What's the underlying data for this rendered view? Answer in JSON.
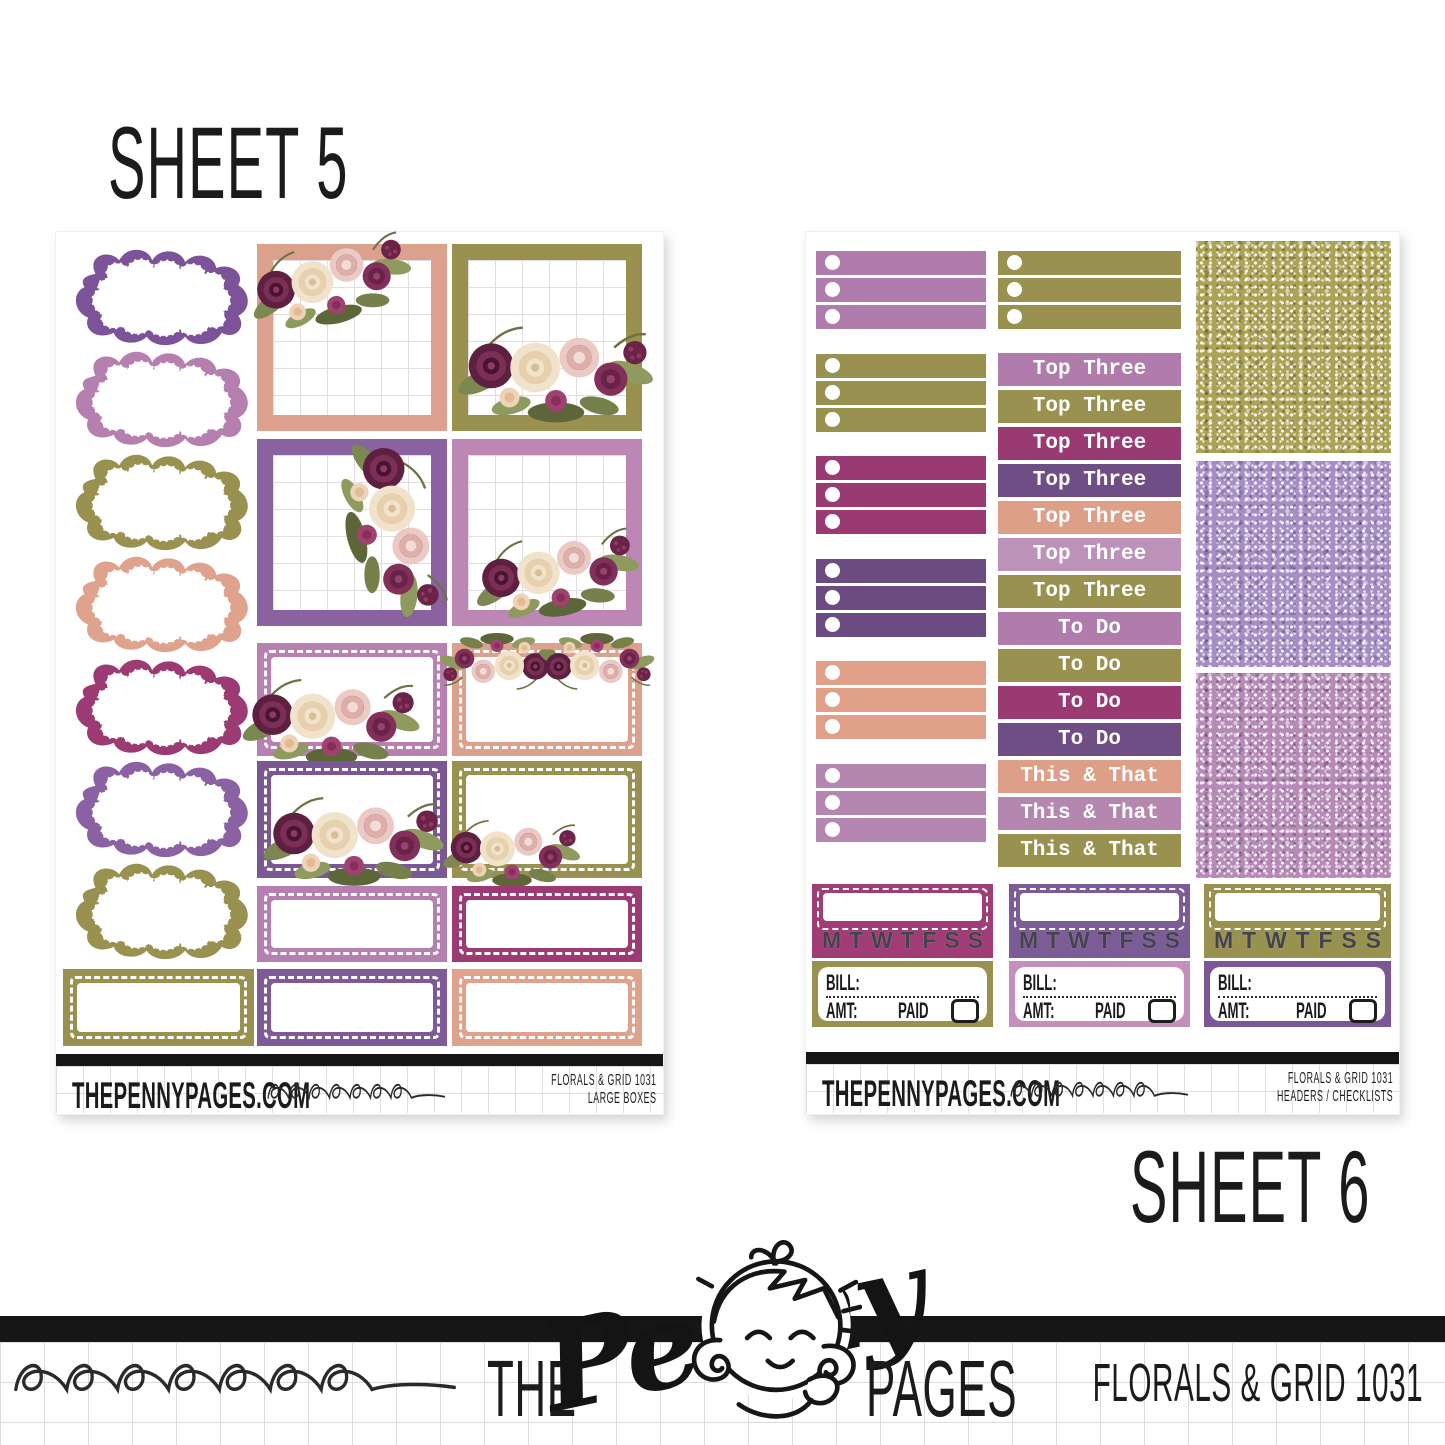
{
  "page": {
    "sheet5_label": "SHEET 5",
    "sheet6_label": "SHEET 6",
    "brand": {
      "the": "THE",
      "penny": "Penny",
      "pages": "PAGES"
    },
    "product_name": "FLORALS & GRID 1031",
    "accent_black": "#161616"
  },
  "days": [
    "M",
    "T",
    "W",
    "T",
    "F",
    "S",
    "S"
  ],
  "sheet5": {
    "footer": {
      "site": "THEPENNYPAGES.COM",
      "product_line1": "FLORALS & GRID 1031",
      "product_line2": "LARGE BOXES"
    },
    "clouds": [
      {
        "color": "#7c5398"
      },
      {
        "color": "#b57fb0"
      },
      {
        "color": "#99914f"
      },
      {
        "color": "#dfa38d"
      },
      {
        "color": "#9c3b73"
      },
      {
        "color": "#8a61a2"
      },
      {
        "color": "#99914f"
      }
    ],
    "bottom_label_box": {
      "color": "#99914f"
    },
    "full_boxes": [
      {
        "frame": "#dba18c",
        "flowers": "top-left"
      },
      {
        "frame": "#99914f",
        "flowers": "bottom"
      },
      {
        "frame": "#8a62a0",
        "flowers": "right"
      },
      {
        "frame": "#bc87b4",
        "flowers": "bottom-right"
      }
    ],
    "half_boxes": [
      {
        "bg": "#b780b1",
        "flowers": "bottom-left"
      },
      {
        "bg": "#dba18c",
        "flowers": "top-corners"
      },
      {
        "bg": "#7b5794",
        "flowers": "bottom"
      },
      {
        "bg": "#99914f",
        "flowers": "bottom-left"
      }
    ],
    "quarter_boxes": [
      {
        "bg": "#b57fb0"
      },
      {
        "bg": "#9c3b73"
      },
      {
        "bg": "#7f5a98"
      },
      {
        "bg": "#dfa38d"
      }
    ]
  },
  "sheet6": {
    "checklist_groups": [
      {
        "color": "#b07cab"
      },
      {
        "color": "#99914f"
      },
      {
        "color": "#9a3a72"
      },
      {
        "color": "#6b4b80"
      },
      {
        "color": "#df9f88"
      },
      {
        "color": "#b586b0"
      }
    ],
    "mid_strip_color": "#99914f",
    "headers": [
      {
        "label": "Top Three",
        "color": "#b07cab"
      },
      {
        "label": "Top Three",
        "color": "#99914f"
      },
      {
        "label": "Top Three",
        "color": "#9a3a72"
      },
      {
        "label": "Top Three",
        "color": "#6f4e85"
      },
      {
        "label": "Top Three",
        "color": "#dd9f88"
      },
      {
        "label": "Top Three",
        "color": "#bd92b8"
      },
      {
        "label": "Top Three",
        "color": "#99914f"
      },
      {
        "label": "To Do",
        "color": "#b07cab"
      },
      {
        "label": "To Do",
        "color": "#99914f"
      },
      {
        "label": "To Do",
        "color": "#9a3a72"
      },
      {
        "label": "To Do",
        "color": "#6f4e85"
      },
      {
        "label": "This & That",
        "color": "#dd9f88"
      },
      {
        "label": "This & That",
        "color": "#b586b0"
      },
      {
        "label": "This & That",
        "color": "#99914f"
      }
    ],
    "glitter_swatches": [
      {
        "name": "olive-glitter",
        "base": "#aca254"
      },
      {
        "name": "lavender-glitter",
        "base": "#a78dc6"
      },
      {
        "name": "orchid-glitter",
        "base": "#b789b9"
      }
    ],
    "date_cover_colors": [
      "#a13d76",
      "#7b5c96",
      "#99914f"
    ],
    "bills": {
      "bill_label": "BILL:",
      "amt_label": "AMT:",
      "paid_label": "PAID",
      "colors": [
        "#99914f",
        "#c48fbc",
        "#7b5796"
      ]
    },
    "footer": {
      "site": "THEPENNYPAGES.COM",
      "product_line1": "FLORALS & GRID 1031",
      "product_line2": "HEADERS / CHECKLISTS"
    }
  }
}
